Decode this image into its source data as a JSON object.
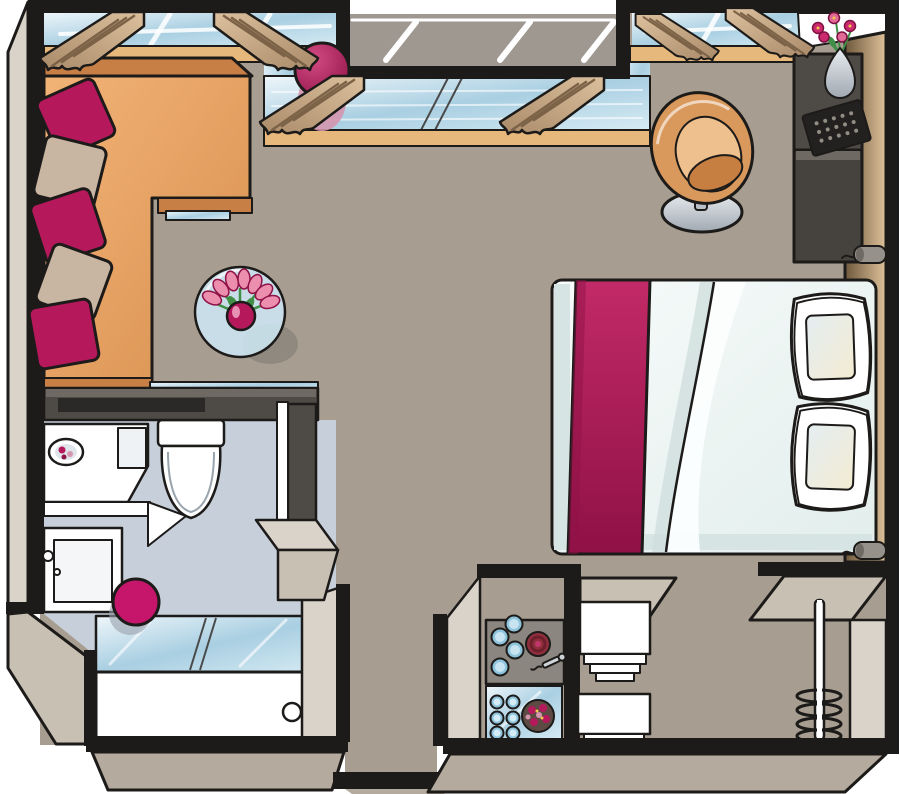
{
  "meta": {
    "title": "Top-down apartment floor plan illustration (hotel suite style)",
    "type": "floor-plan",
    "view": "top-down with extruded walls"
  },
  "palette": {
    "outline": "#1d1b19",
    "white": "#ffffff",
    "floor_main": "#a79e91",
    "floor_bath": "#c7cfda",
    "wall_light": "#dad3ca",
    "wall_mid": "#c9c0b4",
    "wall_bottom": "#b4aa9d",
    "wall_dark": "#4e4a45",
    "wall_dark_top": "#6e6962",
    "dark_block": "#46423d",
    "tv_black": "#2b2927",
    "exterior": "#9e9890",
    "accent": "#b5195c",
    "accent_dark": "#8f1146",
    "stool": "#c5166b",
    "pink_soft": "#d495ae",
    "pillow_beige": "#c8b6a3",
    "sofa_edge": "#c87f45",
    "curtain_line": "#7c6347",
    "sill": "#e7b87c",
    "counter": "#8b867f",
    "burner_red": "#8e2f3e",
    "plate": "#5d4b43",
    "chair_inner": "#eec08e",
    "chair_seat": "#c67f41",
    "green": "#3f8f46"
  },
  "scene": {
    "rooms": [
      {
        "name": "living-area",
        "items": [
          "l-shaped-sofa",
          "magenta-pillows",
          "beige-pillows",
          "round-glass-side-table",
          "tulip-bouquet-vase",
          "exercise-ball",
          "tv-sideboard"
        ]
      },
      {
        "name": "sleeping-area",
        "items": [
          "double-bed",
          "magenta-bed-runner",
          "two-bed-pillows",
          "tub-chair",
          "desk-console",
          "laptop",
          "flower-vase",
          "wardrobe",
          "reading-lights"
        ]
      },
      {
        "name": "bathroom",
        "items": [
          "vanity-with-sink",
          "corner-shelf",
          "cabinet",
          "toilet",
          "bathtub",
          "glass-shower-screen",
          "magenta-stool"
        ]
      },
      {
        "name": "kitchenette",
        "items": [
          "cooktop-glasses",
          "hotplate",
          "corkscrew",
          "glass-serving-tray",
          "tumblers",
          "decorated-plate"
        ]
      },
      {
        "name": "entry",
        "items": [
          "linen-shelves",
          "coat-stand"
        ]
      }
    ],
    "windows": [
      "left-window",
      "bay-window",
      "right-window"
    ],
    "curtain_count": 6
  }
}
